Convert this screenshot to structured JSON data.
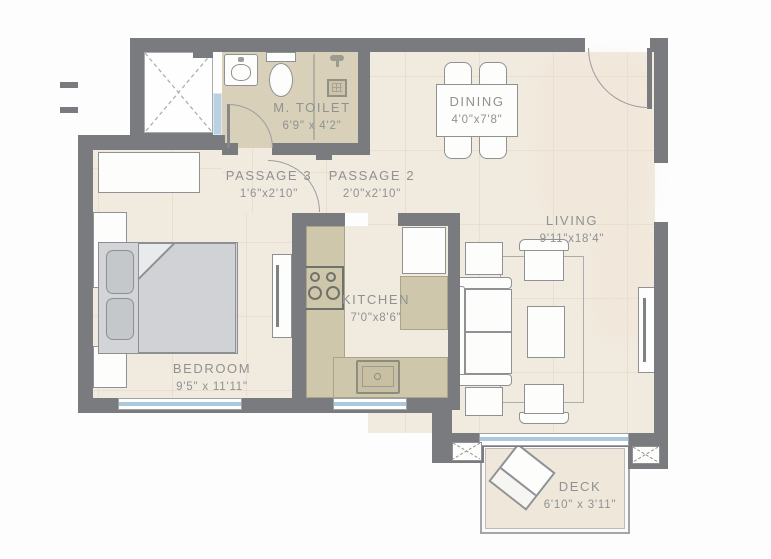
{
  "plan": {
    "type": "apartment-floor-plan",
    "rooms": [
      {
        "name": "M. TOILET",
        "dims": "6'9\" x 4'2\""
      },
      {
        "name": "PASSAGE 3",
        "dims": "1'6\"x2'10\""
      },
      {
        "name": "PASSAGE 2",
        "dims": "2'0\"x2'10\""
      },
      {
        "name": "DINING",
        "dims": "4'0\"x7'8\""
      },
      {
        "name": "LIVING",
        "dims": "9'11\"x18'4\""
      },
      {
        "name": "KITCHEN",
        "dims": "7'0\"x8'6\""
      },
      {
        "name": "BEDROOM",
        "dims": "9'5\" x 11'11\""
      },
      {
        "name": "DECK",
        "dims": "6'10\" x 3'11\""
      }
    ],
    "colors": {
      "wall": "#797b7e",
      "floor": "#f1eade",
      "tile_line": "#e7dfd0",
      "wet_area_floor": "#d8d0b8",
      "counter": "#cfc7ac",
      "window_glass": "#aac9dc",
      "furniture_outline": "#8f9194",
      "bed_fill": "#d2d4d7",
      "label_text": "#8f9193"
    },
    "symbols": [
      "shaft-x",
      "washbasin",
      "wc",
      "shower-drain",
      "dining-table",
      "dining-chair",
      "sofa",
      "armchair",
      "coffee-table",
      "rug",
      "side-table",
      "tv-unit",
      "bed",
      "pillow",
      "wardrobe",
      "stove",
      "sink",
      "fridge",
      "deck-chair",
      "planter",
      "door-swing",
      "window"
    ]
  }
}
